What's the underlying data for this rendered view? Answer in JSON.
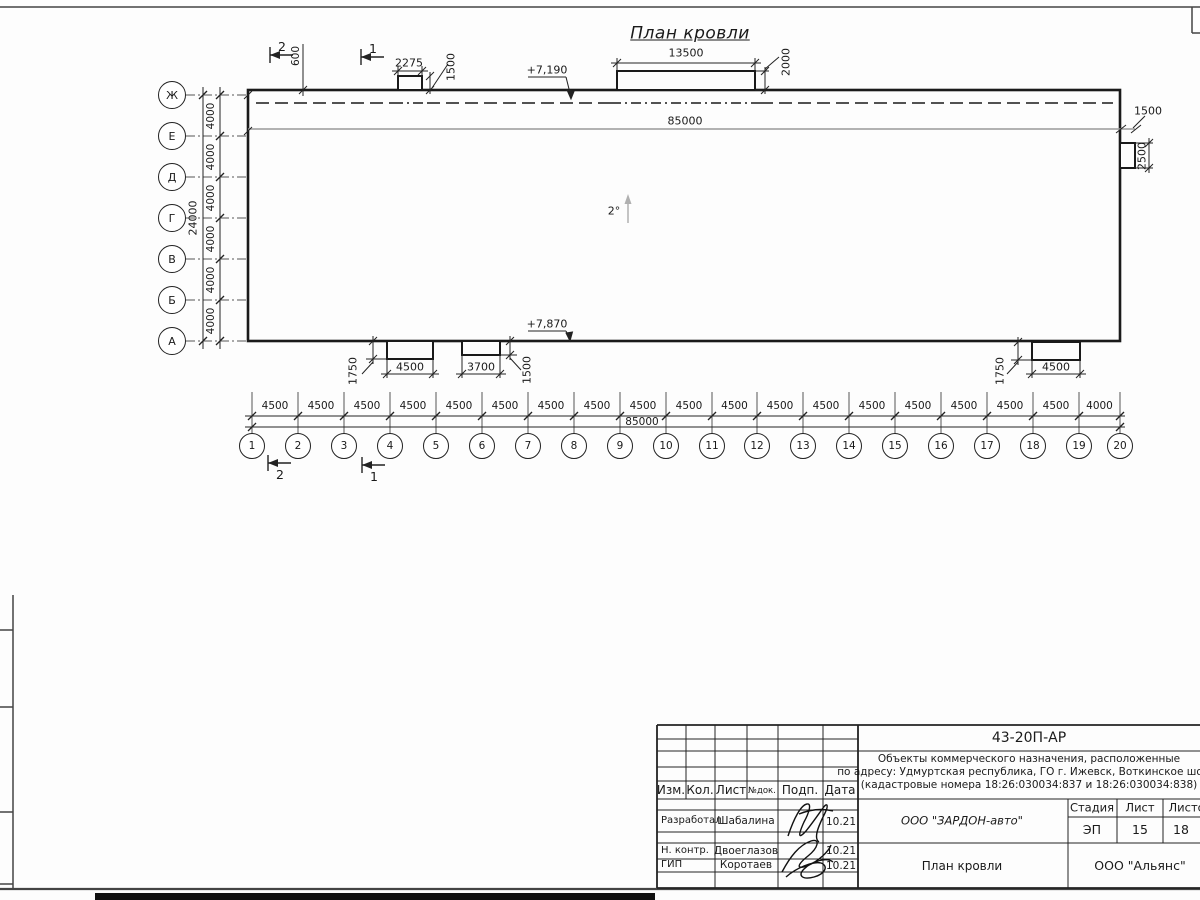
{
  "drawing": {
    "title": "План кровли",
    "slope": "2°",
    "elev_top": "+7,190",
    "elev_bottom": "+7,870",
    "total_top": "85000",
    "total_bottom": "85000",
    "total_left": "24000",
    "dim_600": "600",
    "dim_2275": "2275",
    "dim_1500_top": "1500",
    "dim_13500": "13500",
    "dim_2000": "2000",
    "dim_1500_right": "1500",
    "dim_2500_right": "2500",
    "dim_a_w": "4500",
    "dim_a_h": "1750",
    "dim_b_w": "3700",
    "dim_b_h": "1500",
    "dim_c_w": "4500",
    "dim_c_h": "1750",
    "section_1": "1",
    "section_2": "2",
    "axes_vertical": [
      "Ж",
      "Е",
      "Д",
      "Г",
      "В",
      "Б",
      "А"
    ],
    "axes_vertical_spacing": [
      "4000",
      "4000",
      "4000",
      "4000",
      "4000",
      "4000"
    ],
    "axes_horizontal": [
      "1",
      "2",
      "3",
      "4",
      "5",
      "6",
      "7",
      "8",
      "9",
      "10",
      "11",
      "12",
      "13",
      "14",
      "15",
      "16",
      "17",
      "18",
      "19",
      "20"
    ],
    "axes_horizontal_spacing": [
      "4500",
      "4500",
      "4500",
      "4500",
      "4500",
      "4500",
      "4500",
      "4500",
      "4500",
      "4500",
      "4500",
      "4500",
      "4500",
      "4500",
      "4500",
      "4500",
      "4500",
      "4500",
      "4000"
    ]
  },
  "title_block": {
    "doc_number": "43-20П-АР",
    "project_line1": "Объекты коммерческого назначения, расположенные",
    "project_line2": "по адресу: Удмуртская республика, ГО г. Ижевск, Воткинское шоссе",
    "project_line3": "(кадастровые номера 18:26:030034:837 и 18:26:030034:838)",
    "header": {
      "izm": "Изм.",
      "kol": "Кол.",
      "list": "Лист",
      "ndok": "№док.",
      "podp": "Подп.",
      "data": "Дата"
    },
    "rows": [
      {
        "role": "Разработал",
        "name": "Шабалина",
        "date": "10.21"
      },
      {
        "role": "Н. контр.",
        "name": "Двоеглазов",
        "date": "10.21"
      },
      {
        "role": "ГИП",
        "name": "Коротаев",
        "date": "10.21"
      }
    ],
    "company": "ООО \"ЗАРДОН-авто\"",
    "stage_label": "Стадия",
    "sheet_label": "Лист",
    "sheets_label": "Листов",
    "stage": "ЭП",
    "sheet": "15",
    "sheets": "18",
    "drawing_name": "План кровли",
    "contractor": "ООО \"Альянс\""
  }
}
